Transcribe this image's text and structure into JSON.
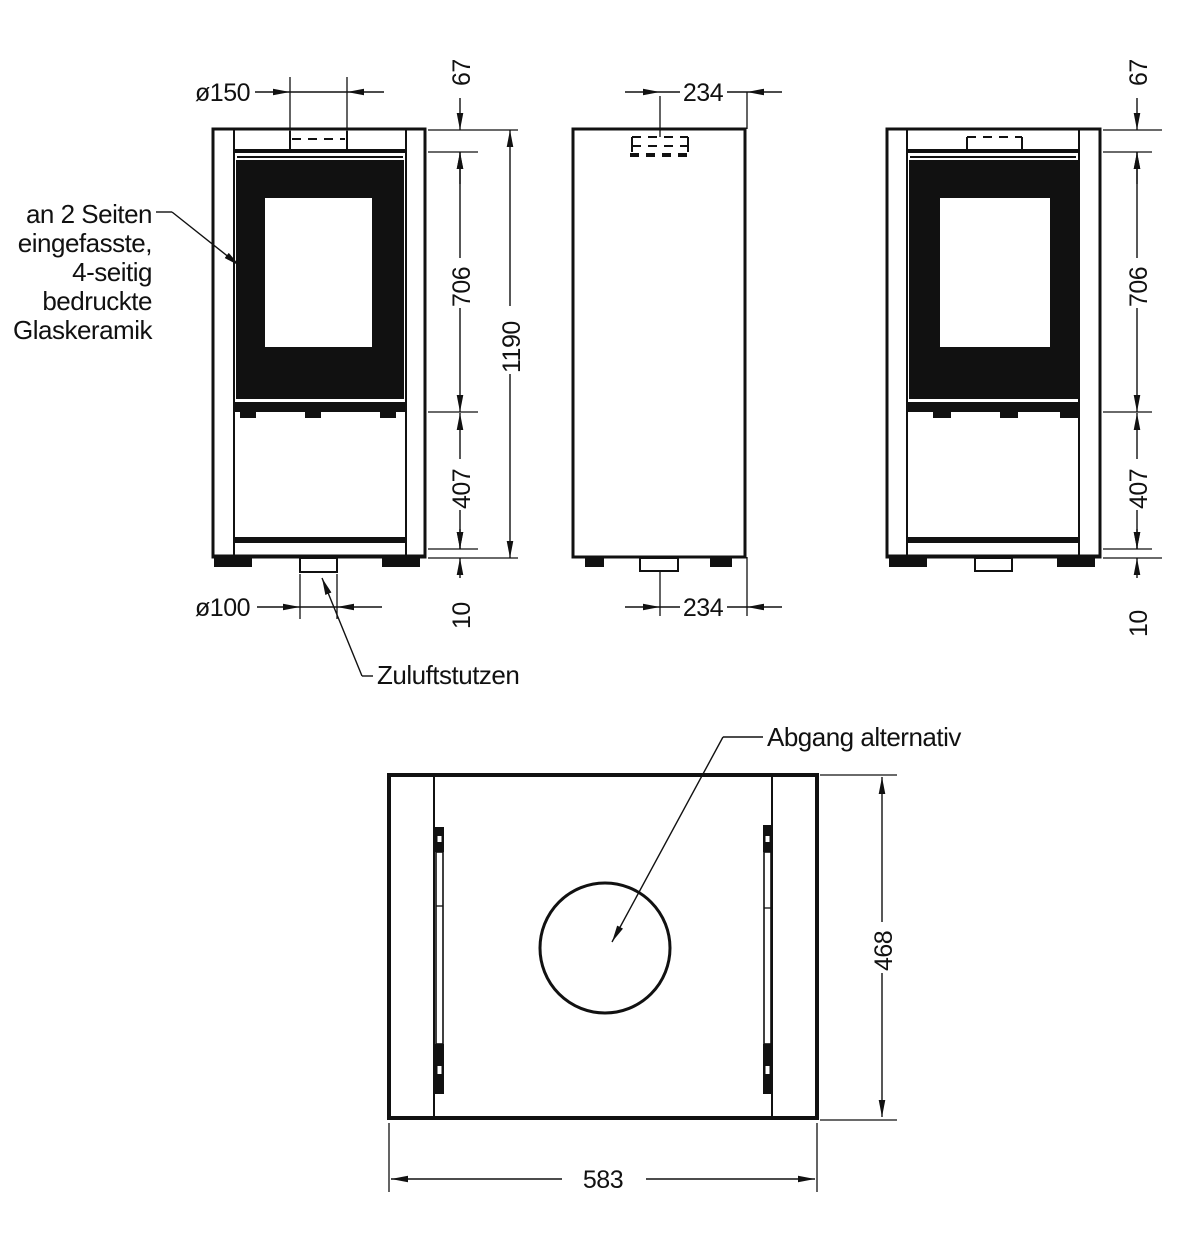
{
  "drawing": {
    "note_glass": {
      "lines": [
        "an 2 Seiten",
        "eingefasste,",
        "4-seitig",
        "bedruckte",
        "Glaskeramik"
      ]
    },
    "label_air_inlet": "Zuluftstutzen",
    "label_alt_outlet": "Abgang alternativ",
    "dims": {
      "flue_dia": "ø150",
      "inlet_dia": "ø100",
      "top_offset": "67",
      "door_height": "706",
      "lower_height": "407",
      "base_gap": "10",
      "total_height": "1190",
      "flue_offset": "234",
      "inlet_offset": "234",
      "width": "583",
      "depth": "468"
    },
    "colors": {
      "line": "#111111",
      "background": "#ffffff"
    }
  }
}
